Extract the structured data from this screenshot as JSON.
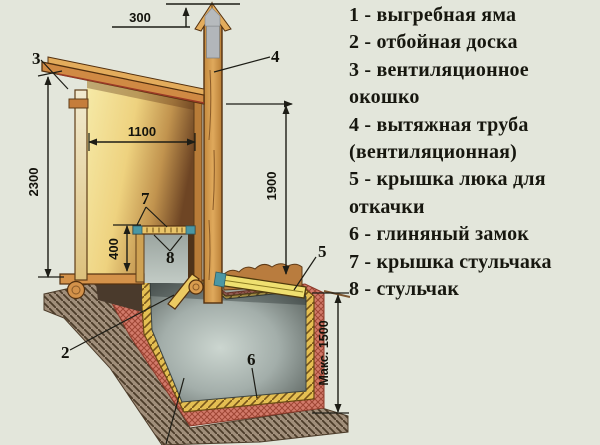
{
  "legend": {
    "items": [
      {
        "line": "1 - выгребная яма"
      },
      {
        "line": "2 - отбойная доска"
      },
      {
        "line": "3 - вентиляционное окошко"
      },
      {
        "line": "4 - вытяжная труба (вентиляционная)"
      },
      {
        "line": "5 - крышка люка для откачки"
      },
      {
        "line": "6 - глиняный замок"
      },
      {
        "line": "7 - крышка стульчака"
      },
      {
        "line": "8 - стульчак"
      }
    ]
  },
  "diagram": {
    "dims": {
      "pipe_above_roof": "300",
      "inner_width": "1100",
      "wall_height": "2300",
      "pipe_height": "1900",
      "seat_height": "400",
      "pit_depth": "Макс. 1500"
    },
    "callouts": {
      "c2": "2",
      "c3": "3",
      "c4": "4",
      "c5": "5",
      "c6": "6",
      "c7": "7",
      "c8": "8"
    },
    "colors": {
      "background": "#e3e6db",
      "wood": "#d08a44",
      "wood_light": "#e9c468",
      "clay_red": "#d27a6a",
      "earth_brown": "#a08e7a",
      "pit_gray": "#a3aeaa",
      "teal": "#4b97a4"
    }
  }
}
